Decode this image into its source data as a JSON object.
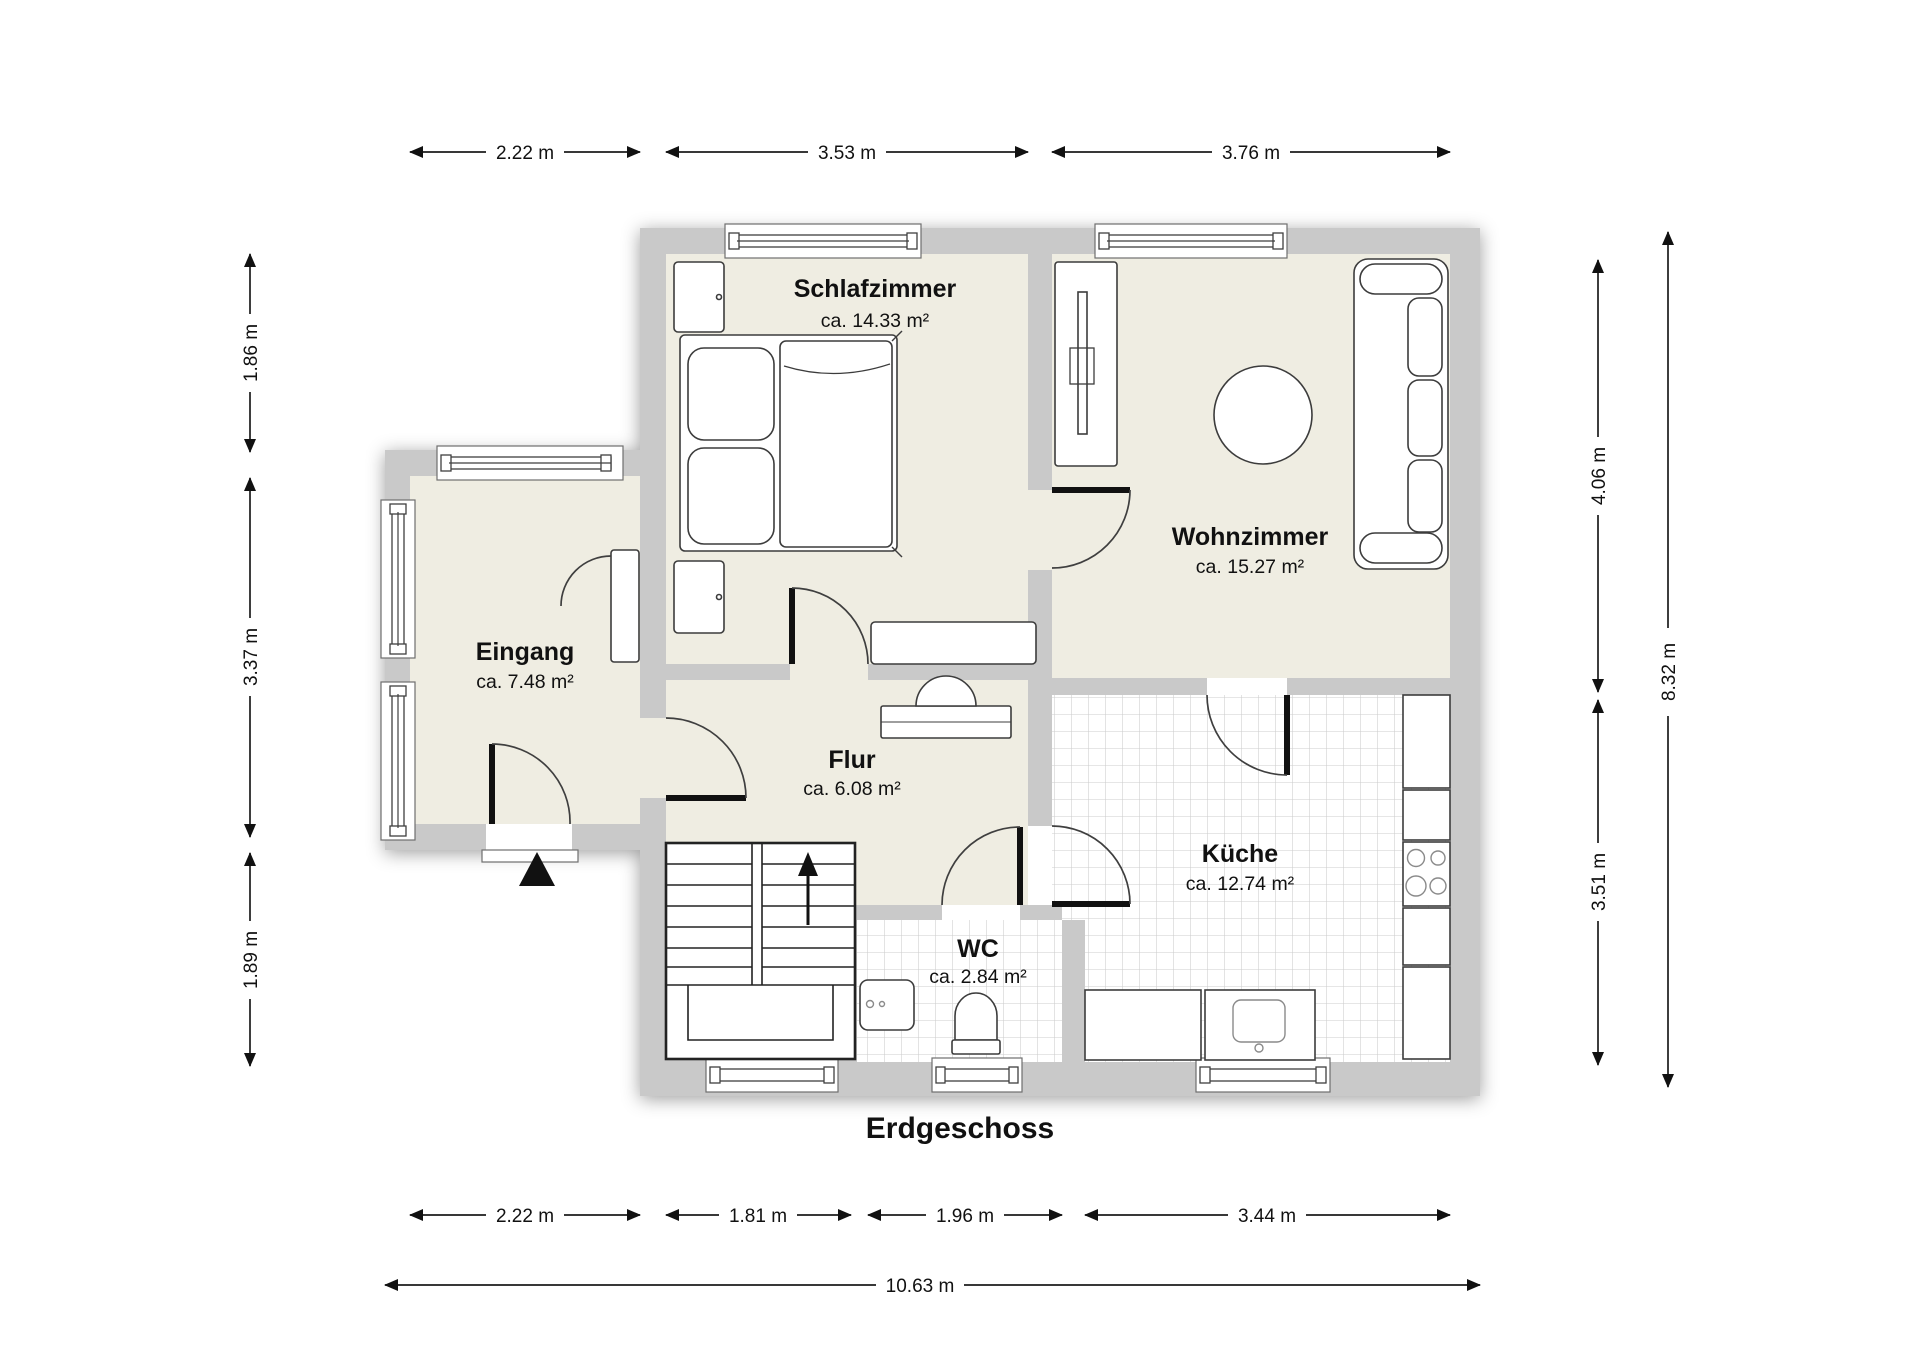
{
  "title": "Erdgeschoss",
  "rooms": [
    {
      "id": "schlafzimmer",
      "name": "Schlafzimmer",
      "area": "ca. 14.33 m²"
    },
    {
      "id": "wohnzimmer",
      "name": "Wohnzimmer",
      "area": "ca. 15.27 m²"
    },
    {
      "id": "eingang",
      "name": "Eingang",
      "area": "ca. 7.48 m²"
    },
    {
      "id": "flur",
      "name": "Flur",
      "area": "ca. 6.08 m²"
    },
    {
      "id": "kueche",
      "name": "Küche",
      "area": "ca. 12.74 m²"
    },
    {
      "id": "wc",
      "name": "WC",
      "area": "ca. 2.84 m²"
    }
  ],
  "dims": {
    "top": [
      {
        "label": "2.22 m"
      },
      {
        "label": "3.53 m"
      },
      {
        "label": "3.76 m"
      }
    ],
    "bottom": [
      {
        "label": "2.22 m"
      },
      {
        "label": "1.81 m"
      },
      {
        "label": "1.96 m"
      },
      {
        "label": "3.44 m"
      }
    ],
    "bottom_total": {
      "label": "10.63 m"
    },
    "left": [
      {
        "label": "1.86 m"
      },
      {
        "label": "3.37 m"
      },
      {
        "label": "1.89 m"
      }
    ],
    "right": [
      {
        "label": "4.06 m"
      },
      {
        "label": "3.51 m"
      }
    ],
    "right_total": {
      "label": "8.32 m"
    }
  },
  "colors": {
    "wall": "#c9c9c9",
    "floor": "#efede2",
    "tile_line": "#cccccc",
    "outline": "#1c1c1c"
  }
}
